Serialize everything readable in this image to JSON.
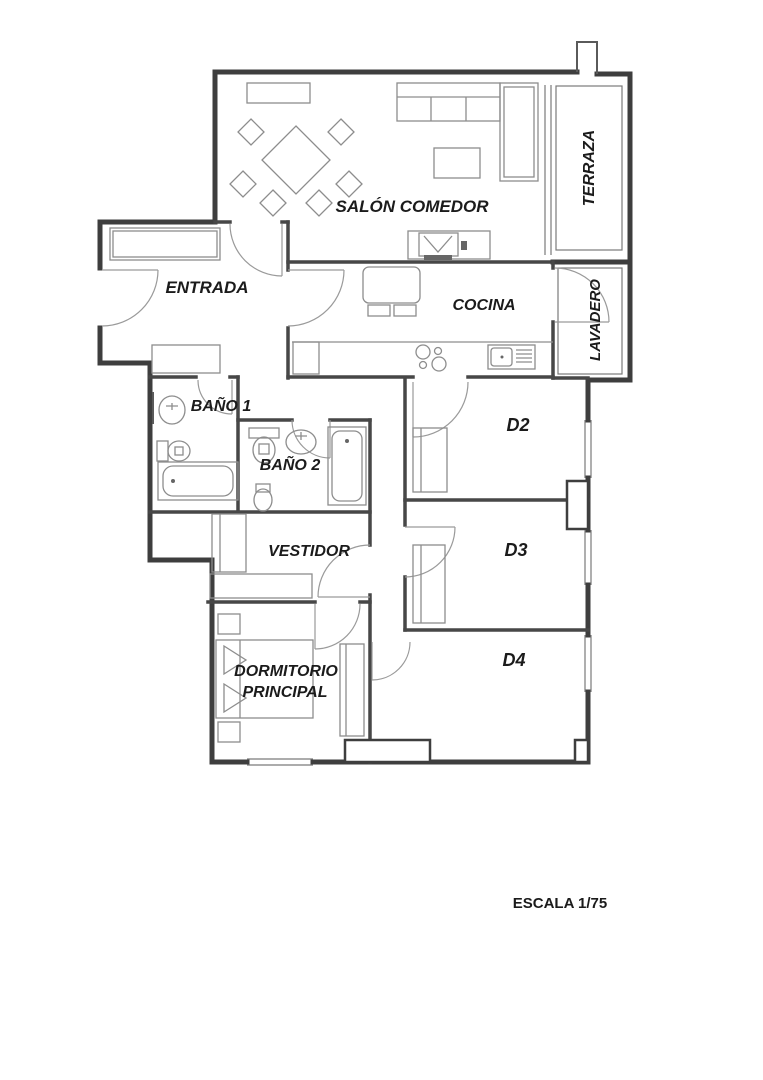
{
  "document": {
    "type": "apartment floor plan",
    "scale_label": "ESCALA 1/75"
  },
  "rooms": {
    "salon_comedor": "SALÓN COMEDOR",
    "terraza": "TERRAZA",
    "entrada": "ENTRADA",
    "cocina": "COCINA",
    "lavadero": "LAVADERO",
    "bano1": "BAÑO 1",
    "bano2": "BAÑO 2",
    "vestidor": "VESTIDOR",
    "dormitorio_line1": "DORMITORIO",
    "dormitorio_line2": "PRINCIPAL",
    "d2": "D2",
    "d3": "D3",
    "d4": "D4"
  },
  "colors": {
    "exterior_wall": "#3e3e3e",
    "interior_wall": "#474747",
    "furniture": "#8d8d8d",
    "door_swing": "#9a9a9a",
    "label_text": "#1b1b1b",
    "background": "#ffffff"
  }
}
